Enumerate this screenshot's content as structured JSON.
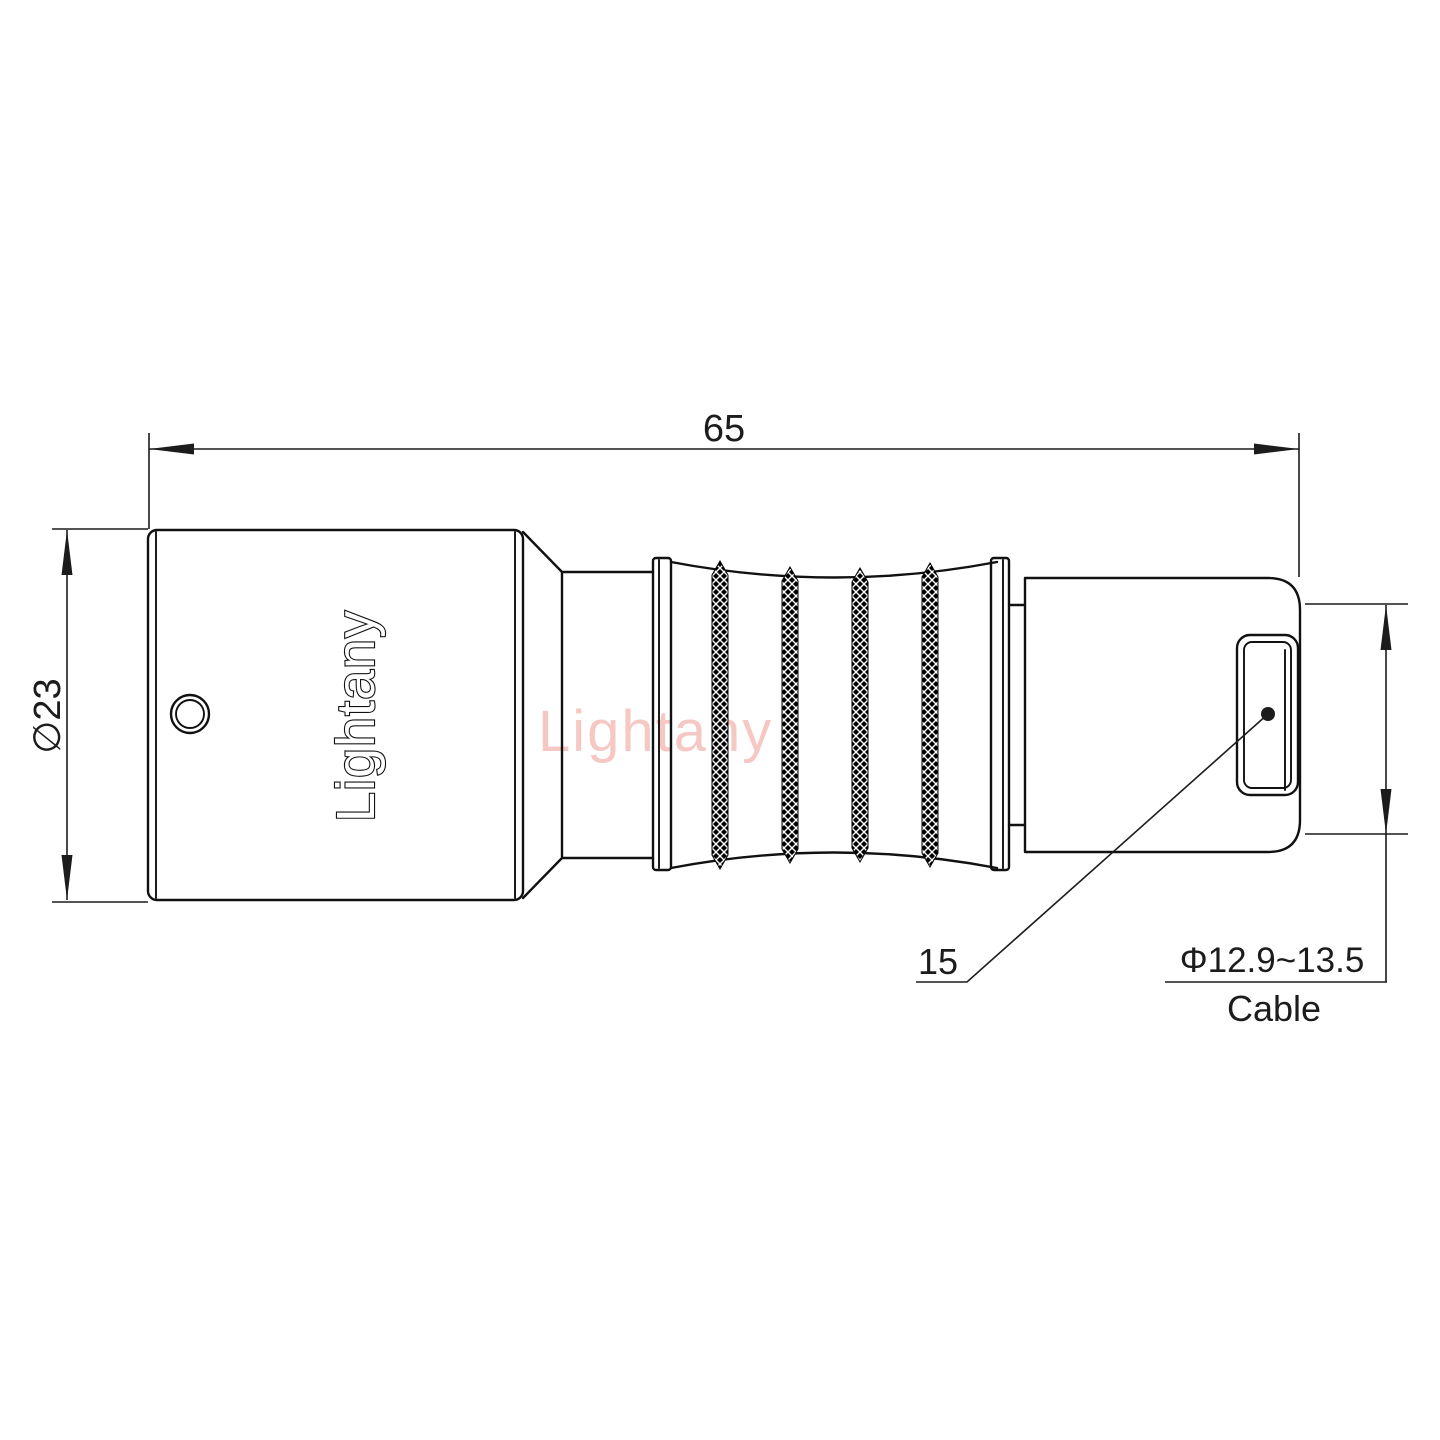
{
  "watermark": {
    "text": "Lightany",
    "color": "#e97164"
  },
  "part": {
    "brand": "Lightany"
  },
  "dimensions": {
    "overall_length": "65",
    "shell_diameter": "∅23",
    "nut_length": "15",
    "cable_range": "Φ12.9~13.5",
    "cable_label": "Cable"
  }
}
